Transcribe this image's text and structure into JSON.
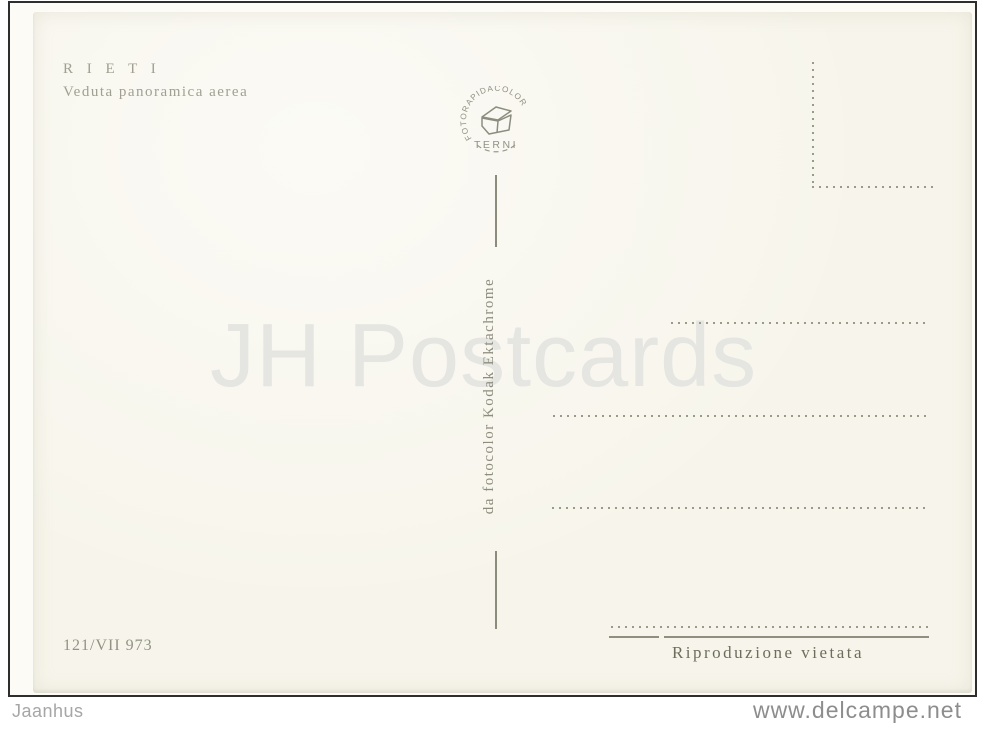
{
  "postcard": {
    "title": "R I E T I",
    "subtitle": "Veduta panoramica aerea",
    "stamp": {
      "arc_text": "FOTORAPIDACOLOR",
      "city": "TERNI"
    },
    "film_credit": "da fotocolor Kodak Ektachrome",
    "catalog_number": "121/VII 973",
    "reproduction_notice": "Riproduzione vietata",
    "watermark": "JH Postcards"
  },
  "footer": {
    "seller": "Jaanhus",
    "site": "www.delcampe.net"
  },
  "colors": {
    "card_paper": "#f7f5eb",
    "ink_light": "#a0a092",
    "ink_dark": "#6d6d5d",
    "dotted_lines": "#9a9a8b",
    "watermark": "#e5e5e1",
    "scan_border": "#2e2e2e"
  }
}
